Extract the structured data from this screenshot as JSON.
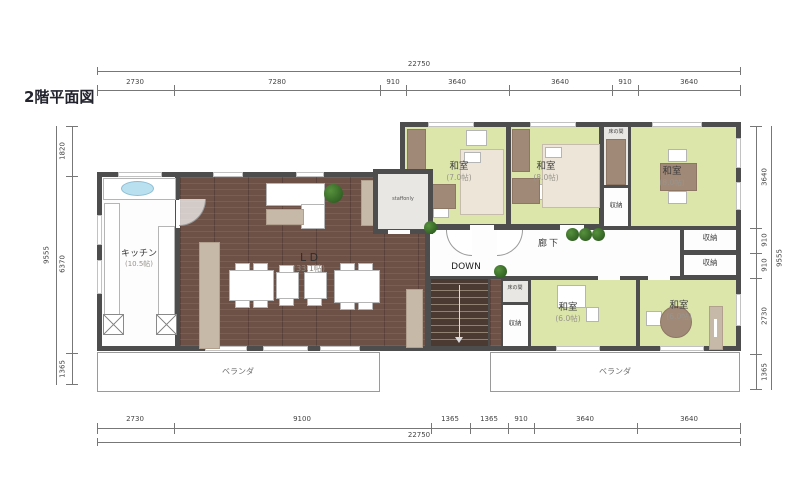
{
  "title": "2階平面図",
  "dimensions": {
    "top": {
      "total": "22750",
      "segments": [
        "2730",
        "7280",
        "910",
        "3640",
        "3640",
        "910",
        "3640"
      ]
    },
    "bottom": {
      "total": "22750",
      "segments": [
        "2730",
        "9100",
        "1365",
        "1365",
        "910",
        "3640",
        "3640"
      ]
    },
    "left": {
      "total": "9555",
      "segments": [
        "1820",
        "6370",
        "1365"
      ]
    },
    "right": {
      "total": "9555",
      "segments": [
        "3640",
        "910",
        "910",
        "2730",
        "1365"
      ]
    }
  },
  "rooms": {
    "kitchen": {
      "name": "キッチン",
      "size": "(10.5帖)"
    },
    "living_dining": {
      "name": "L D",
      "size": "(33.1帖)"
    },
    "washitsu_top_left": {
      "name": "和室",
      "size": "(7.0帖)"
    },
    "washitsu_top_mid": {
      "name": "和室",
      "size": "(8.0帖)"
    },
    "washitsu_top_right": {
      "name": "和室",
      "size": "(8.0帖)"
    },
    "washitsu_bottom_mid": {
      "name": "和室",
      "size": "(6.0帖)"
    },
    "washitsu_bottom_right": {
      "name": "和室",
      "size": "(6.0帖)"
    },
    "corridor": {
      "name": "廊下"
    },
    "staff_room": {
      "name": "staffonly"
    },
    "stairs": {
      "name": "DOWN"
    },
    "tokonoma_top": {
      "name": "床の間"
    },
    "tokonoma_bottom": {
      "name": "床の間"
    },
    "storage_top_strip": {
      "name": "収納"
    },
    "storage_right_1": {
      "name": "収納"
    },
    "storage_right_2": {
      "name": "収納"
    },
    "storage_bottom": {
      "name": "収納"
    },
    "balcony_left": {
      "name": "ベランダ"
    },
    "balcony_right": {
      "name": "ベランダ"
    }
  },
  "colors": {
    "wall": "#4d4d4d",
    "tatami_floor": "#dce6ab",
    "wood_floor": "#6d5147",
    "furniture_beige": "#c7b9a7",
    "furniture_brown": "#a18977",
    "plant_green": "#2e6b22",
    "sink_blue": "#b8e0ef"
  }
}
